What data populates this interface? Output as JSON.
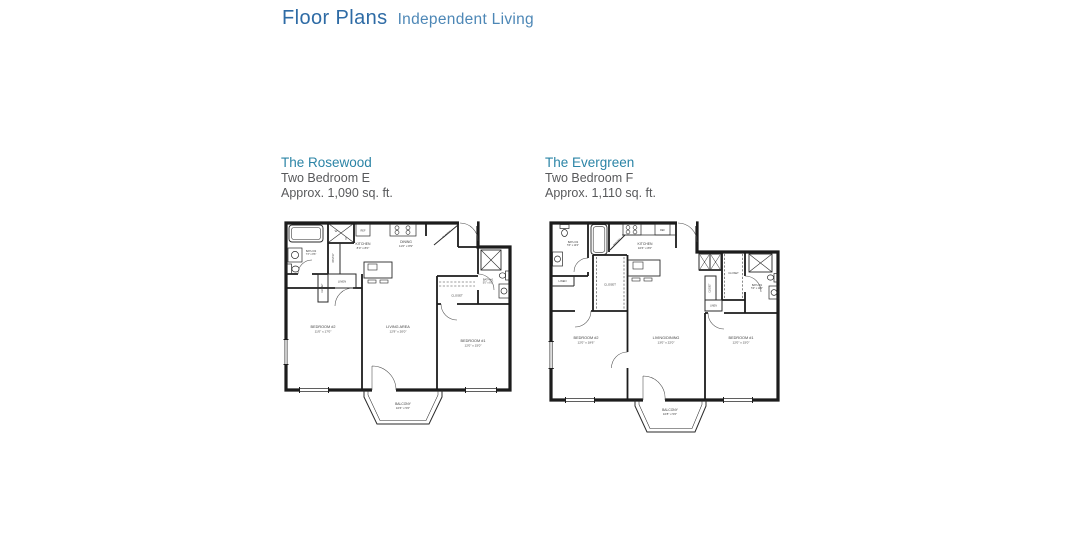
{
  "header": {
    "title": "Floor Plans",
    "subtitle": "Independent Living"
  },
  "colors": {
    "title_blue": "#2e6ba5",
    "subtitle_blue": "#4d87b6",
    "plan_name_teal": "#2b84a6",
    "body_gray": "#58595b",
    "line_black": "#1c1c1c"
  },
  "plans": [
    {
      "name": "The Rosewood",
      "type": "Two Bedroom E",
      "area": "Approx. 1,090 sq. ft.",
      "rooms": {
        "bedroom2": {
          "name": "BEDROOM #2",
          "dims": "11'0\" x 17'0\""
        },
        "living": {
          "name": "LIVING AREA",
          "dims": "12'9\" x 20'0\""
        },
        "bedroom1": {
          "name": "BEDROOM #1",
          "dims": "12'0\" x 15'0\""
        },
        "kitchen": {
          "name": "KITCHEN",
          "dims": "8'0\" x 8'0\""
        },
        "dining": {
          "name": "DINING",
          "dims": "11'0\" x 8'9\""
        },
        "balcony": {
          "name": "BALCONY",
          "dims": "10'6\" x 5'0\""
        },
        "bath2": {
          "name": "BATH #2",
          "dims": "7'3\" x 8'6\""
        },
        "bath1": {
          "name": "BATH #1",
          "dims": "5'0\" x 8'0\""
        }
      },
      "labels": {
        "closet": "CLOSET",
        "linen": "LINEN",
        "pantry": "PANTRY",
        "ref": "REF",
        "washer": "W",
        "dryer": "D"
      }
    },
    {
      "name": "The Evergreen",
      "type": "Two Bedroom F",
      "area": "Approx. 1,110 sq. ft.",
      "rooms": {
        "bedroom2": {
          "name": "BEDROOM #2",
          "dims": "12'0\" x 18'6\""
        },
        "living": {
          "name": "LIVING/DINING",
          "dims": "13'0\" x 22'0\""
        },
        "bedroom1": {
          "name": "BEDROOM #1",
          "dims": "12'0\" x 15'0\""
        },
        "kitchen": {
          "name": "KITCHEN",
          "dims": "10'6\" x 8'0\""
        },
        "balcony": {
          "name": "BALCONY",
          "dims": "10'8\" x 5'0\""
        },
        "bath2": {
          "name": "BATH #2",
          "dims": "5'3\" x 10'0\""
        },
        "bath1": {
          "name": "BATH #1",
          "dims": "5'0\" x 10'0\""
        }
      },
      "labels": {
        "closet": "CLOSET",
        "linen": "LINEN",
        "pantry": "PANTRY",
        "ref": "REF"
      }
    }
  ]
}
